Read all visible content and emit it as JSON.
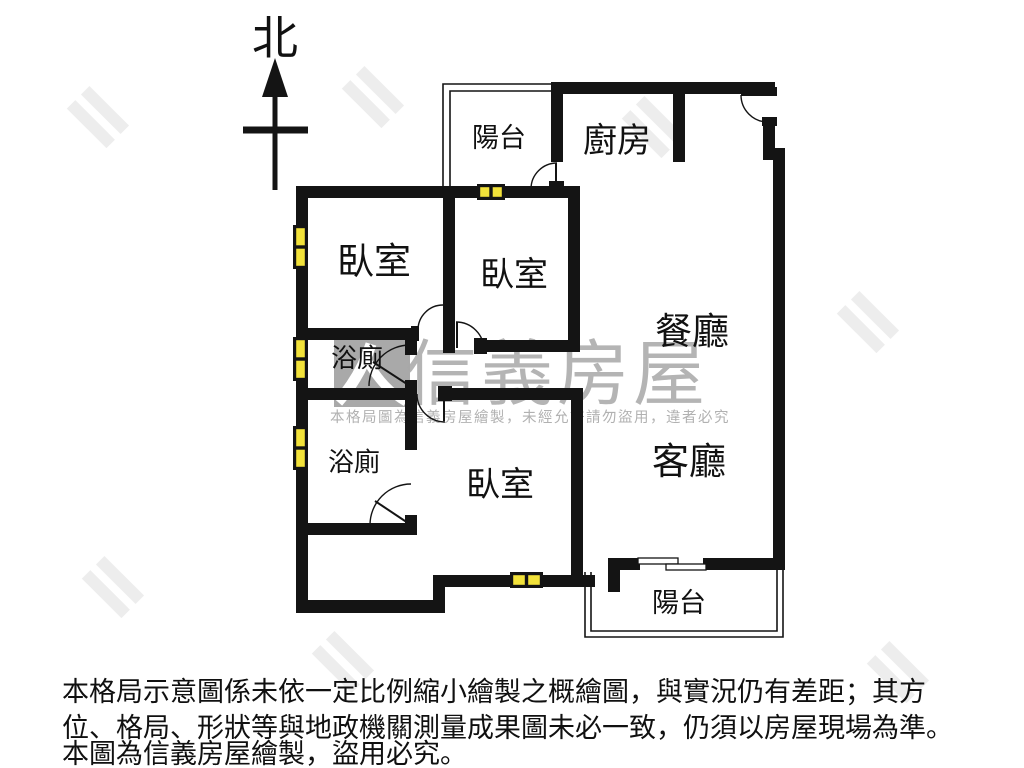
{
  "north_indicator": {
    "label": "北"
  },
  "rooms": {
    "balcony_top": {
      "label": "陽台"
    },
    "kitchen": {
      "label": "廚房"
    },
    "bedroom_1": {
      "label": "臥室"
    },
    "bedroom_2": {
      "label": "臥室"
    },
    "dining": {
      "label": "餐廳"
    },
    "bathroom_1": {
      "label": "浴廁"
    },
    "bathroom_2": {
      "label": "浴廁"
    },
    "bedroom_3": {
      "label": "臥室"
    },
    "living": {
      "label": "客廳"
    },
    "balcony_bottom": {
      "label": "陽台"
    }
  },
  "watermark": {
    "brand": "信義房屋",
    "notice": "本格局圖為信義房屋繪製，未經允許請勿盜用，違者必究"
  },
  "disclaimer": {
    "line1": "本格局示意圖係未依一定比例縮小繪製之概繪圖，與實況仍有差距；其方",
    "line2": "位、格局、形狀等與地政機關測量成果圖未必一致，仍須以房屋現場為準。",
    "line3": "本圖為信義房屋繪製，盜用必究。"
  },
  "colors": {
    "wall": "#141414",
    "window": "#f2e23a",
    "watermark_gray": "#a8a8a8"
  }
}
